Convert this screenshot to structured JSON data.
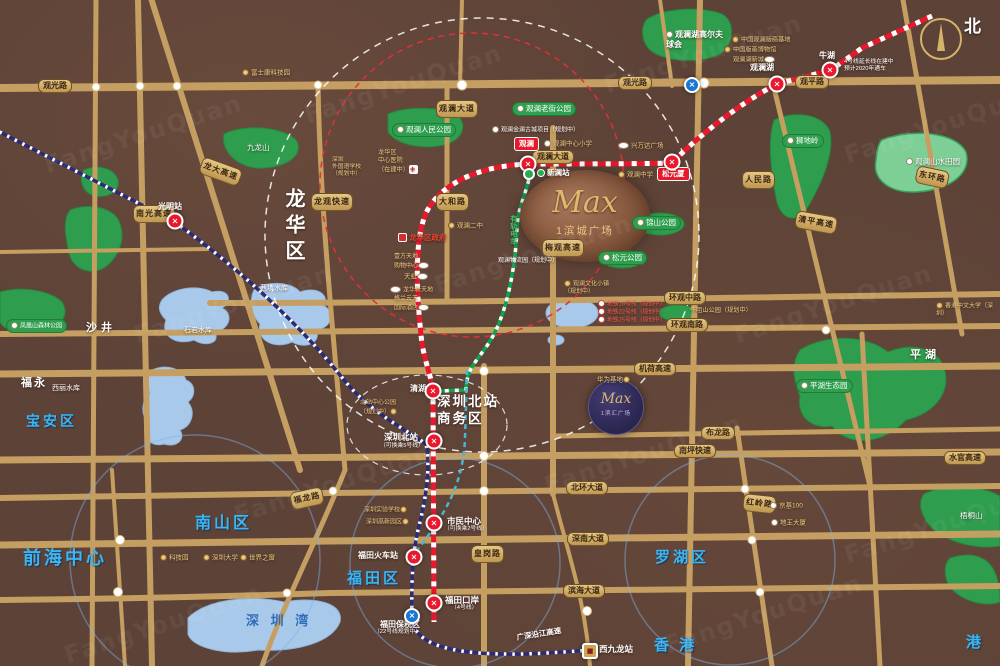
{
  "watermark": "FangYouQuan",
  "compass": {
    "north_label": "北"
  },
  "projects": {
    "main": {
      "brand": "Max",
      "name": "1滨城广场"
    },
    "secondary": {
      "brand": "Max",
      "name": "1滨汇广场"
    }
  },
  "colors": {
    "road": "#c59f61",
    "park": "#2e9d4d",
    "water": "#a9c9ea",
    "line4": "#e8192c",
    "rail": "#2b2b77",
    "tram": "#0aa64f",
    "accent_gold": "#e9cb82"
  },
  "labels": [
    {
      "n": "road-guanguang-w",
      "t": "观光路",
      "x": 38,
      "y": 79,
      "c": "rp"
    },
    {
      "n": "road-guanguang-e",
      "t": "观光路",
      "x": 618,
      "y": 76,
      "c": "rp"
    },
    {
      "n": "road-guanping",
      "t": "观平路",
      "x": 795,
      "y": 75,
      "c": "rp"
    },
    {
      "n": "road-guanlan-avenue",
      "t": "观澜大道",
      "x": 532,
      "y": 150,
      "c": "rp"
    },
    {
      "n": "road-huanguan-middle",
      "t": "环观中路",
      "x": 664,
      "y": 291,
      "c": "rp"
    },
    {
      "n": "road-huanguan-south",
      "t": "环观南路",
      "x": 666,
      "y": 318,
      "c": "rp"
    },
    {
      "n": "road-jihe-expwy",
      "t": "机荷高速",
      "x": 634,
      "y": 362,
      "c": "rp"
    },
    {
      "n": "road-bulong",
      "t": "布龙路",
      "x": 701,
      "y": 426,
      "c": "rp"
    },
    {
      "n": "road-nanping-expwy",
      "t": "南坪快速",
      "x": 674,
      "y": 444,
      "c": "rp"
    },
    {
      "n": "road-shuiguan-expwy",
      "t": "水官高速",
      "x": 944,
      "y": 451,
      "c": "rp"
    },
    {
      "n": "road-beihuan",
      "t": "北环大道",
      "x": 566,
      "y": 481,
      "c": "rp"
    },
    {
      "n": "road-shennan",
      "t": "深南大道",
      "x": 567,
      "y": 532,
      "c": "rp"
    },
    {
      "n": "road-binhai",
      "t": "滨海大道",
      "x": 563,
      "y": 584,
      "c": "rp"
    },
    {
      "n": "road-nanguang",
      "t": "南光高速",
      "x": 133,
      "y": 205,
      "c": "rp rpv"
    },
    {
      "n": "road-longda",
      "t": "龙大高速",
      "x": 204,
      "y": 156,
      "c": "rp rpv",
      "r": 20
    },
    {
      "n": "road-longguan",
      "t": "龙观快速",
      "x": 311,
      "y": 193,
      "c": "rp rpv"
    },
    {
      "n": "road-guanlan-avenue-n",
      "t": "观澜大道",
      "x": 436,
      "y": 100,
      "c": "rp rpv"
    },
    {
      "n": "road-dahe",
      "t": "大和路",
      "x": 436,
      "y": 193,
      "c": "rp rpv"
    },
    {
      "n": "road-meiguan",
      "t": "梅观高速",
      "x": 542,
      "y": 239,
      "c": "rp rpv"
    },
    {
      "n": "road-renmin",
      "t": "人民路",
      "x": 742,
      "y": 171,
      "c": "rp rpv"
    },
    {
      "n": "road-qingping",
      "t": "清平高速",
      "x": 797,
      "y": 210,
      "c": "rp rpv",
      "r": 10
    },
    {
      "n": "road-donghuan",
      "t": "东环路",
      "x": 918,
      "y": 165,
      "c": "rp rpv",
      "r": 12
    },
    {
      "n": "road-huanggang",
      "t": "皇岗路",
      "x": 471,
      "y": 545,
      "c": "rp rpv"
    },
    {
      "n": "road-hongling",
      "t": "红岭路",
      "x": 744,
      "y": 493,
      "c": "rp rpv",
      "r": 6
    },
    {
      "n": "road-fulong",
      "t": "福龙路",
      "x": 289,
      "y": 493,
      "c": "rp rpv",
      "r": -12
    },
    {
      "n": "road-yanjiang",
      "t": "广深沿江高速",
      "x": 516,
      "y": 633,
      "c": "white",
      "s": 7.5,
      "b": 1,
      "r": -9
    },
    {
      "n": "district-longhua",
      "t": "龙华区",
      "x": 280,
      "y": 188,
      "c": "white",
      "s": 20,
      "b": 1,
      "ls": 6,
      "v": 1
    },
    {
      "n": "district-baoan",
      "t": "宝安区",
      "x": 26,
      "y": 413,
      "c": "blue-big",
      "s": 14
    },
    {
      "n": "district-nanshan",
      "t": "南山区",
      "x": 195,
      "y": 514,
      "c": "blue-big",
      "s": 16
    },
    {
      "n": "district-luohu",
      "t": "罗湖区",
      "x": 655,
      "y": 549,
      "c": "blue-big",
      "s": 15
    },
    {
      "n": "district-futian",
      "t": "福田区",
      "x": 347,
      "y": 570,
      "c": "blue-big",
      "s": 15
    },
    {
      "n": "area-qianhai",
      "t": "前海中心",
      "x": 23,
      "y": 547,
      "c": "blue-big",
      "s": 18
    },
    {
      "n": "area-hongkong",
      "t": "香 港",
      "x": 654,
      "y": 637,
      "c": "blue-big",
      "s": 15
    },
    {
      "n": "area-hongkong-2",
      "t": "港",
      "x": 966,
      "y": 634,
      "c": "blue-big",
      "s": 15
    },
    {
      "n": "area-shajing",
      "t": "沙井",
      "x": 86,
      "y": 322,
      "c": "white",
      "s": 11,
      "b": 1,
      "ls": 4
    },
    {
      "n": "area-fuyong",
      "t": "福永",
      "x": 21,
      "y": 377,
      "c": "white",
      "s": 11,
      "b": 1,
      "ls": 2
    },
    {
      "n": "area-pinghu",
      "t": "平湖",
      "x": 910,
      "y": 349,
      "c": "white",
      "s": 11,
      "b": 1,
      "ls": 4
    },
    {
      "n": "label-shenzhen-bay",
      "t": "深 圳 湾",
      "x": 246,
      "y": 613,
      "c": "bay",
      "s": 13,
      "ls": 4
    },
    {
      "n": "label-north-station-cbd",
      "t": "深圳北站\n商务区",
      "x": 437,
      "y": 394,
      "c": "white",
      "s": 13.5,
      "b": 1,
      "ls": 2
    },
    {
      "n": "water-xikeng",
      "t": "茜坑水库",
      "x": 260,
      "y": 285,
      "c": "white",
      "s": 7
    },
    {
      "n": "water-shiyan",
      "t": "石岩水库",
      "x": 184,
      "y": 327,
      "c": "white",
      "s": 7
    },
    {
      "n": "water-xili",
      "t": "西丽水库",
      "x": 52,
      "y": 385,
      "c": "white",
      "s": 7
    },
    {
      "n": "mount-jiulong",
      "t": "九龙山",
      "x": 247,
      "y": 143,
      "c": "white",
      "s": 7.5
    },
    {
      "n": "mount-wutong",
      "t": "梧桐山",
      "x": 960,
      "y": 511,
      "c": "white",
      "s": 7.5
    },
    {
      "n": "park-renmin",
      "t": "观澜人民公园",
      "x": 392,
      "y": 123,
      "c": "gp",
      "ic": "wd"
    },
    {
      "n": "park-laojie",
      "t": "观澜老街公园",
      "x": 512,
      "y": 102,
      "c": "gp",
      "ic": "wd"
    },
    {
      "n": "park-shidiling",
      "t": "狮地岭",
      "x": 782,
      "y": 134,
      "c": "gp",
      "ic": "wd"
    },
    {
      "n": "park-jinshan",
      "t": "锦山公园",
      "x": 632,
      "y": 216,
      "c": "gp",
      "ic": "wd"
    },
    {
      "n": "park-songyuan",
      "t": "松元公园",
      "x": 598,
      "y": 251,
      "c": "gp",
      "ic": "wd"
    },
    {
      "n": "park-fenghuangshan",
      "t": "凤凰山森林公园",
      "x": 6,
      "y": 319,
      "c": "gp",
      "s": 6,
      "ic": "wd"
    },
    {
      "n": "park-pinghu-eco",
      "t": "平湖生态园",
      "x": 796,
      "y": 379,
      "c": "gp",
      "ic": "wd"
    },
    {
      "n": "park-shanshui-tianyuan",
      "t": "观澜山水田园",
      "x": 906,
      "y": 157,
      "c": "white",
      "s": 7.5,
      "ic": "wd"
    },
    {
      "n": "park-golf-club",
      "t": "观澜湖高尔夫\n球会",
      "x": 666,
      "y": 30,
      "c": "white",
      "s": 8,
      "b": 1,
      "ic": "wd"
    },
    {
      "n": "note-niuju-park",
      "t": "牛咀山公园（规划中）",
      "x": 690,
      "y": 307,
      "c": "gold",
      "s": 6.2
    },
    {
      "n": "st-label-guangming",
      "t": "光明站",
      "x": 158,
      "y": 202,
      "c": "white",
      "s": 8,
      "b": 1
    },
    {
      "n": "st-label-guanlanhu",
      "t": "观澜湖",
      "x": 750,
      "y": 63,
      "c": "white",
      "s": 8,
      "b": 1
    },
    {
      "n": "st-label-niuhu",
      "t": "牛湖",
      "x": 819,
      "y": 51,
      "c": "white",
      "s": 8,
      "b": 1
    },
    {
      "n": "note-line4-extension",
      "t": "4号线延长线在建中\n预计2020年通车",
      "x": 844,
      "y": 59,
      "c": "white",
      "s": 5.8
    },
    {
      "n": "st-label-xinlan",
      "t": "新澜站",
      "x": 537,
      "y": 168,
      "c": "white",
      "s": 7.5,
      "b": 1,
      "ic": "gdot"
    },
    {
      "n": "st-pill-guanlan",
      "t": "观澜",
      "x": 514,
      "y": 137,
      "c": "redpill"
    },
    {
      "n": "st-pill-songyuanxia",
      "t": "松元厦",
      "x": 657,
      "y": 167,
      "c": "redpill"
    },
    {
      "n": "st-label-qinghu",
      "t": "清湖",
      "x": 410,
      "y": 384,
      "c": "white",
      "s": 8,
      "b": 1
    },
    {
      "n": "st-label-szbei",
      "t": "深圳北站",
      "x": 384,
      "y": 432,
      "c": "white",
      "s": 8.5,
      "b": 1
    },
    {
      "n": "st-sub-szbei",
      "t": "（可换乘5号线）",
      "x": 380,
      "y": 443,
      "c": "white",
      "s": 5.8
    },
    {
      "n": "st-label-civic-center",
      "t": "市民中心",
      "x": 447,
      "y": 516,
      "c": "white",
      "s": 8.5,
      "b": 1
    },
    {
      "n": "st-sub-civic-center",
      "t": "（可换乘2号线）",
      "x": 444,
      "y": 526,
      "c": "white",
      "s": 5.8
    },
    {
      "n": "st-label-futian-rail",
      "t": "福田火车站",
      "x": 358,
      "y": 551,
      "c": "white",
      "s": 8,
      "b": 1
    },
    {
      "n": "st-label-futian-port",
      "t": "福田口岸",
      "x": 445,
      "y": 595,
      "c": "white",
      "s": 8.5,
      "b": 1
    },
    {
      "n": "st-sub-futian-port",
      "t": "（4号线）",
      "x": 451,
      "y": 605,
      "c": "white",
      "s": 5.8
    },
    {
      "n": "st-label-futian-bonded",
      "t": "福田保税区",
      "x": 380,
      "y": 620,
      "c": "white",
      "s": 8,
      "b": 1
    },
    {
      "n": "st-sub-futian-bonded",
      "t": "（22号线规划中）",
      "x": 374,
      "y": 629,
      "c": "white",
      "s": 5.8
    },
    {
      "n": "st-label-west-kowloon",
      "t": "西九龙站",
      "x": 599,
      "y": 644,
      "c": "white",
      "s": 8.5,
      "b": 1
    },
    {
      "n": "poi-foxconn",
      "t": "富士康科技园",
      "x": 242,
      "y": 69,
      "c": "gold",
      "s": 6.5,
      "ic": "gd"
    },
    {
      "n": "poi-printmaking-base",
      "t": "中国观澜版画基地",
      "x": 732,
      "y": 36,
      "c": "gold",
      "s": 6.2,
      "ic": "gd"
    },
    {
      "n": "poi-printmaking-museum",
      "t": "中国版画博物馆",
      "x": 724,
      "y": 46,
      "c": "gold",
      "s": 6.2,
      "ic": "gd"
    },
    {
      "n": "poi-guanlanhu-newtown",
      "t": "观澜湖新城",
      "x": 733,
      "y": 56,
      "c": "gold",
      "s": 6.2,
      "ic": "ov",
      "ir": 1
    },
    {
      "n": "poi-ancient-town",
      "t": "观澜金澜古城项目（规划中）",
      "x": 492,
      "y": 126,
      "c": "white",
      "s": 6,
      "ic": "wd"
    },
    {
      "n": "poi-center-primary",
      "t": "观澜中心小学",
      "x": 544,
      "y": 140,
      "c": "gold",
      "s": 6.5,
      "ic": "wd"
    },
    {
      "n": "poi-wanda-plaza",
      "t": "兴万达广场",
      "x": 618,
      "y": 142,
      "c": "gold",
      "s": 6.5,
      "ic": "ov"
    },
    {
      "n": "poi-guanlan-middle",
      "t": "观澜中学",
      "x": 618,
      "y": 171,
      "c": "gold",
      "s": 6.5,
      "ic": "gd"
    },
    {
      "n": "poi-guanlan-2nd-middle",
      "t": "观澜二中",
      "x": 448,
      "y": 222,
      "c": "gold",
      "s": 6.5,
      "ic": "gd"
    },
    {
      "n": "poi-longhua-hospital",
      "t": "龙华区\n中心医院\n（在建中）",
      "x": 378,
      "y": 149,
      "c": "gold",
      "s": 6.2,
      "ic": "cross",
      "ir": 1
    },
    {
      "n": "poi-sz-foreign-school",
      "t": "深圳\n外国语学校\n（规划中）",
      "x": 332,
      "y": 157,
      "c": "gold",
      "s": 5.8
    },
    {
      "n": "poi-longhua-gov",
      "t": "龙华区政府",
      "x": 398,
      "y": 233,
      "c": "redtxt",
      "s": 7.5,
      "b": 1,
      "ic": "gov"
    },
    {
      "n": "poi-yifang-tiandi",
      "t": "壹方天地\n购物中心",
      "x": 394,
      "y": 254,
      "c": "gold",
      "s": 6,
      "ic": "ov",
      "ir": 1
    },
    {
      "n": "poi-tianhong",
      "t": "天虹",
      "x": 404,
      "y": 273,
      "c": "gold",
      "s": 6.5,
      "ic": "ov",
      "ir": 1
    },
    {
      "n": "poi-longhua-xintiandi",
      "t": "龙华新天地",
      "x": 390,
      "y": 286,
      "c": "gold",
      "s": 6,
      "ic": "ov"
    },
    {
      "n": "poi-grand-skylight",
      "t": "格兰云天\n国际酒店",
      "x": 394,
      "y": 296,
      "c": "gold",
      "s": 6,
      "ic": "ov",
      "ir": 1
    },
    {
      "n": "label-tram",
      "t": "有轨电车",
      "x": 509,
      "y": 215,
      "c": "tram",
      "s": 7.5,
      "b": 1,
      "v": 1
    },
    {
      "n": "poi-wenhua-town",
      "t": "观澜文化小镇\n（规划中）",
      "x": 564,
      "y": 280,
      "c": "gold",
      "s": 6,
      "ic": "gd"
    },
    {
      "n": "note-wuliuyuan",
      "t": "观澜物流园（规划中）",
      "x": 498,
      "y": 258,
      "c": "white",
      "s": 6
    },
    {
      "n": "note-metro-18",
      "t": "地铁18号线（规划中）",
      "x": 598,
      "y": 300,
      "c": "rednote",
      "s": 5.8,
      "ic": "num"
    },
    {
      "n": "note-metro-22",
      "t": "地铁22号线（规划中）",
      "x": 598,
      "y": 308,
      "c": "rednote",
      "s": 5.8,
      "ic": "num"
    },
    {
      "n": "note-metro-25",
      "t": "地铁25号线（规划中）",
      "x": 598,
      "y": 316,
      "c": "rednote",
      "s": 5.8,
      "ic": "num"
    },
    {
      "n": "poi-huawei-base",
      "t": "华为基地",
      "x": 597,
      "y": 376,
      "c": "gold",
      "s": 6.5,
      "ic": "gd",
      "ir": 1
    },
    {
      "n": "poi-beizhan-park",
      "t": "北站中心公园\n（规划中）",
      "x": 360,
      "y": 400,
      "c": "gold",
      "s": 6,
      "ic": "gd",
      "ir": 1
    },
    {
      "n": "poi-sz-experimental",
      "t": "深圳实验学校",
      "x": 364,
      "y": 506,
      "c": "gold",
      "s": 6,
      "ic": "gd",
      "ir": 1
    },
    {
      "n": "poi-sz-hitech",
      "t": "深圳高新园区",
      "x": 366,
      "y": 518,
      "c": "gold",
      "s": 6,
      "ic": "gd",
      "ir": 1
    },
    {
      "n": "poi-kejiyuan",
      "t": "科技园",
      "x": 160,
      "y": 554,
      "c": "gold",
      "s": 6.5,
      "ic": "gd"
    },
    {
      "n": "poi-shenzhen-university",
      "t": "深圳大学",
      "x": 203,
      "y": 554,
      "c": "gold",
      "s": 6.5,
      "ic": "gd"
    },
    {
      "n": "poi-window-of-world",
      "t": "世界之窗",
      "x": 240,
      "y": 554,
      "c": "gold",
      "s": 6.5,
      "ic": "gd"
    },
    {
      "n": "poi-kk100",
      "t": "京基100",
      "x": 770,
      "y": 502,
      "c": "gold",
      "s": 6.5,
      "ic": "wd"
    },
    {
      "n": "poi-diwang",
      "t": "地王大厦",
      "x": 771,
      "y": 519,
      "c": "gold",
      "s": 6.5,
      "ic": "wd"
    },
    {
      "n": "poi-cuhk-sz",
      "t": "香港中文大学（深圳）",
      "x": 936,
      "y": 302,
      "c": "gold",
      "s": 6,
      "ic": "gd"
    }
  ],
  "stations": [
    {
      "n": "station-guangming",
      "t": "red",
      "x": 175,
      "y": 221
    },
    {
      "n": "station-guanlanhu",
      "t": "red",
      "x": 777,
      "y": 84
    },
    {
      "n": "station-niuhu",
      "t": "red",
      "x": 830,
      "y": 70
    },
    {
      "n": "station-guanlan",
      "t": "red",
      "x": 528,
      "y": 164
    },
    {
      "n": "station-songyuanxia",
      "t": "red",
      "x": 672,
      "y": 162
    },
    {
      "n": "station-xinlan",
      "t": "green",
      "x": 529,
      "y": 174
    },
    {
      "n": "station-qinghu",
      "t": "red",
      "x": 433,
      "y": 391
    },
    {
      "n": "station-shenzhenbei",
      "t": "red",
      "x": 434,
      "y": 441
    },
    {
      "n": "station-civic-center",
      "t": "red",
      "x": 434,
      "y": 523
    },
    {
      "n": "station-futian-rail",
      "t": "red",
      "x": 414,
      "y": 557
    },
    {
      "n": "station-futian-port",
      "t": "red",
      "x": 434,
      "y": 603
    },
    {
      "n": "station-futian-bonded",
      "t": "blue",
      "x": 412,
      "y": 616
    },
    {
      "n": "station-metro-logo",
      "t": "blue",
      "x": 692,
      "y": 85
    },
    {
      "n": "station-west-kowloon",
      "t": "train",
      "x": 590,
      "y": 651
    }
  ]
}
